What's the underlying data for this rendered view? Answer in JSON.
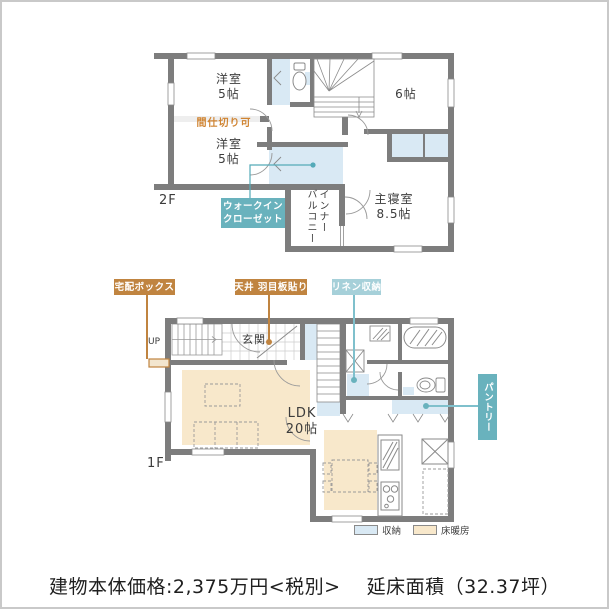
{
  "colors": {
    "wall": "#7d7d7d",
    "storage_fill": "#d9e9f4",
    "floor_heating_fill": "#f8e8cb",
    "callout_orange": "#c08440",
    "callout_teal": "#69b2bd",
    "callout_teal_light": "#a6d0d9",
    "partition_text": "#d08432"
  },
  "floor2": {
    "label": "2F",
    "room_west_upper": {
      "name": "洋室",
      "size": "5帖"
    },
    "room_west_lower": {
      "name": "洋室",
      "size": "5帖"
    },
    "partition_note": "間仕切り可",
    "room_east": {
      "size": "6帖"
    },
    "master_bedroom": {
      "name": "主寝室",
      "size": "8.5帖"
    },
    "balcony": {
      "line1": "インナー",
      "line2": "バルコニー"
    },
    "wic": {
      "line1": "ウォークイン",
      "line2": "クローゼット"
    }
  },
  "floor1": {
    "label": "1F",
    "entrance": "玄関",
    "stairs_up": "UP",
    "ldk": {
      "name": "LDK",
      "size": "20帖"
    },
    "callout_delivery_box": "宅配ボックス",
    "callout_ceiling_panel": "天井 羽目板貼り",
    "callout_linen_storage": "リネン収納",
    "callout_pantry": "パントリー"
  },
  "legend": {
    "storage": "収納",
    "floor_heating": "床暖房"
  },
  "footer": {
    "price": "建物本体価格:2,375万円<税別>",
    "floor_area": "延床面積（32.37坪）"
  }
}
